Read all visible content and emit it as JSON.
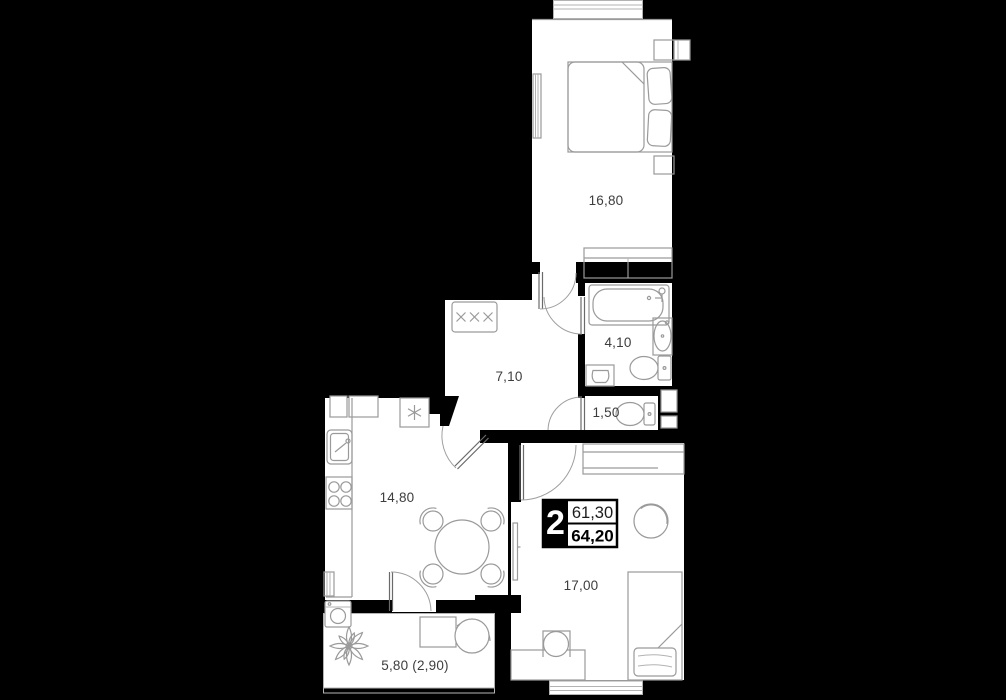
{
  "floorplan": {
    "unit_badge": {
      "rooms": "2",
      "living_area": "61,30",
      "total_area": "64,20"
    },
    "room_labels": {
      "bedroom": "16,80",
      "bathroom": "4,10",
      "hallway": "7,10",
      "wc": "1,50",
      "kitchen": "14,80",
      "living_room": "17,00",
      "balcony": "5,80 (2,90)"
    },
    "colors": {
      "background": "#000000",
      "room_fill": "#ffffff",
      "wall": "#000000",
      "furniture_stroke": "#9a9a9a",
      "label_text": "#3d3d3d"
    }
  }
}
